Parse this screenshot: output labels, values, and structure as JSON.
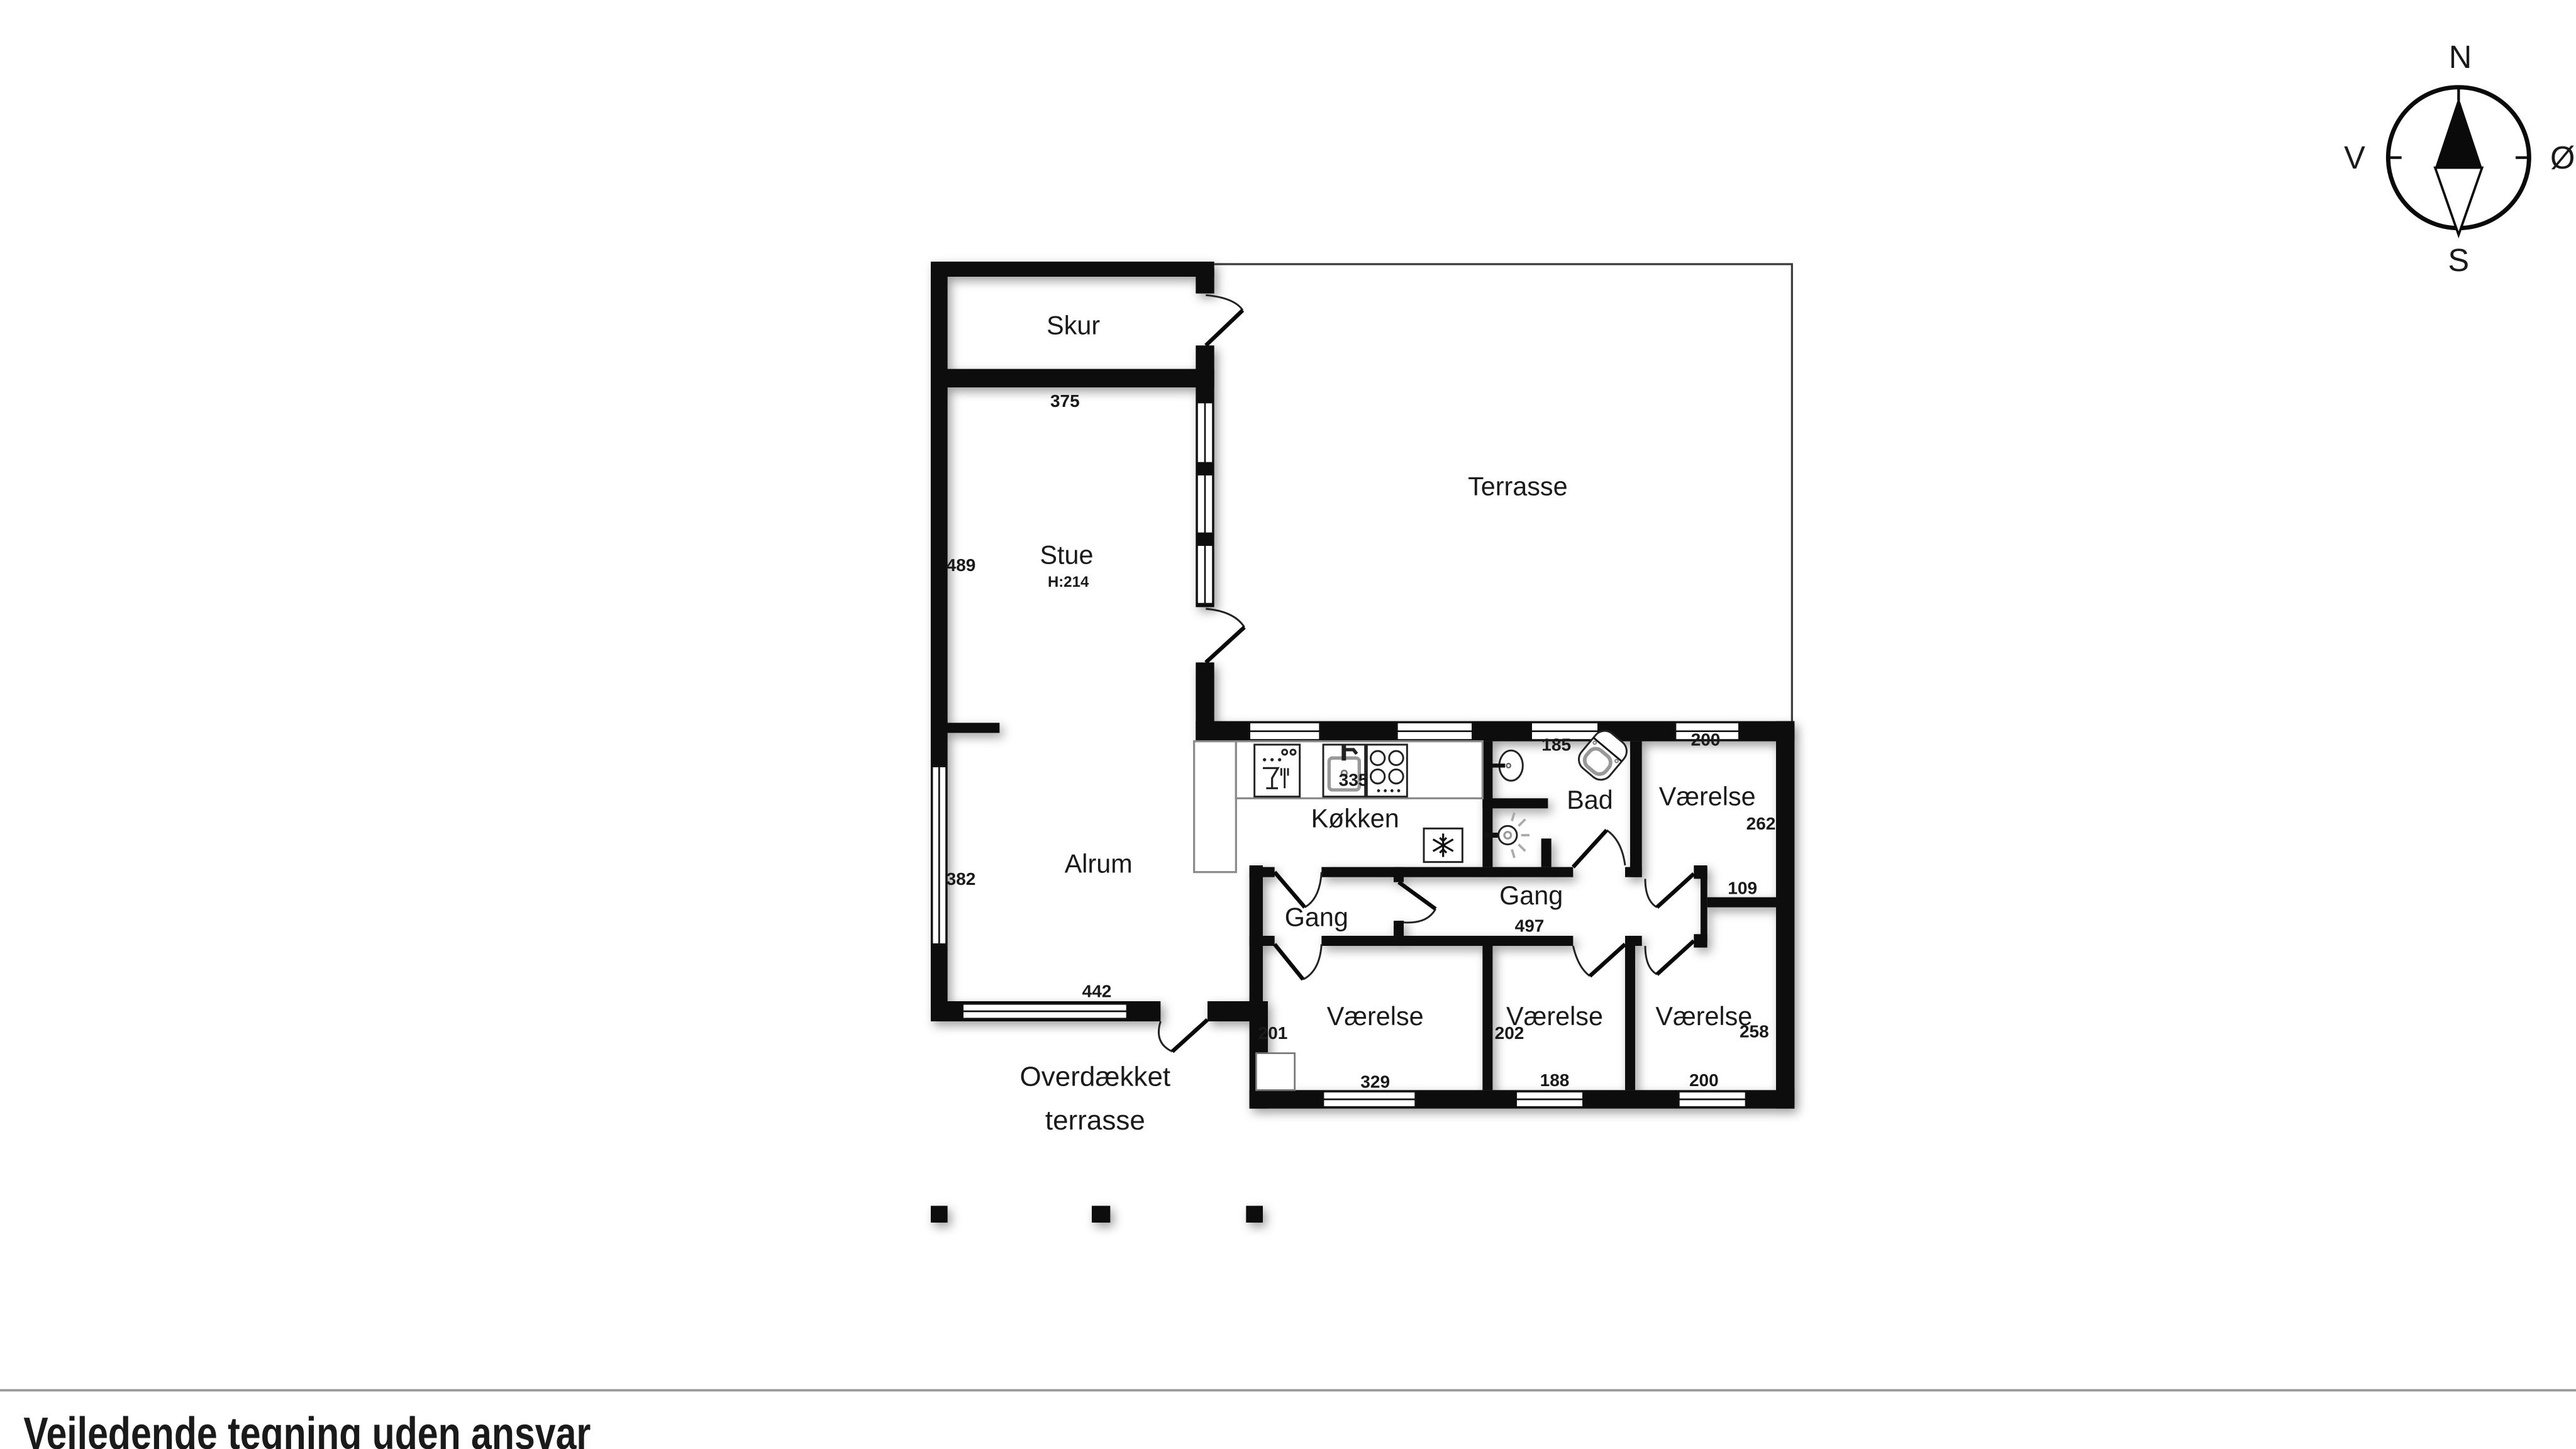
{
  "disclaimer": "Vejledende tegning uden ansvar",
  "compass": {
    "north": "N",
    "south": "S",
    "east": "Ø",
    "west": "V"
  },
  "rooms": {
    "skur": {
      "label": "Skur",
      "width_cm": "375"
    },
    "stue": {
      "label": "Stue",
      "ceiling_height": "H:214",
      "depth_cm": "489"
    },
    "terrasse": {
      "label": "Terrasse"
    },
    "alrum": {
      "label": "Alrum",
      "depth_cm": "382",
      "width_cm": "442"
    },
    "koekken": {
      "label": "Køkken",
      "width_cm": "335"
    },
    "bad": {
      "label": "Bad",
      "width_cm": "185"
    },
    "gang_vest": {
      "label": "Gang"
    },
    "gang": {
      "label": "Gang",
      "length_cm": "497",
      "nook_cm": "109"
    },
    "vaerelse_ne": {
      "label": "Værelse",
      "width_cm": "200",
      "depth_cm": "262"
    },
    "vaerelse_sv": {
      "label": "Værelse",
      "depth_cm": "201",
      "width_cm": "329"
    },
    "vaerelse_s": {
      "label": "Værelse",
      "depth_cm": "202",
      "width_cm": "188"
    },
    "vaerelse_se": {
      "label": "Værelse",
      "depth_cm": "258",
      "width_cm": "200"
    },
    "overdaekket_terrasse": {
      "label_line1": "Overdækket",
      "label_line2": "terrasse"
    }
  }
}
